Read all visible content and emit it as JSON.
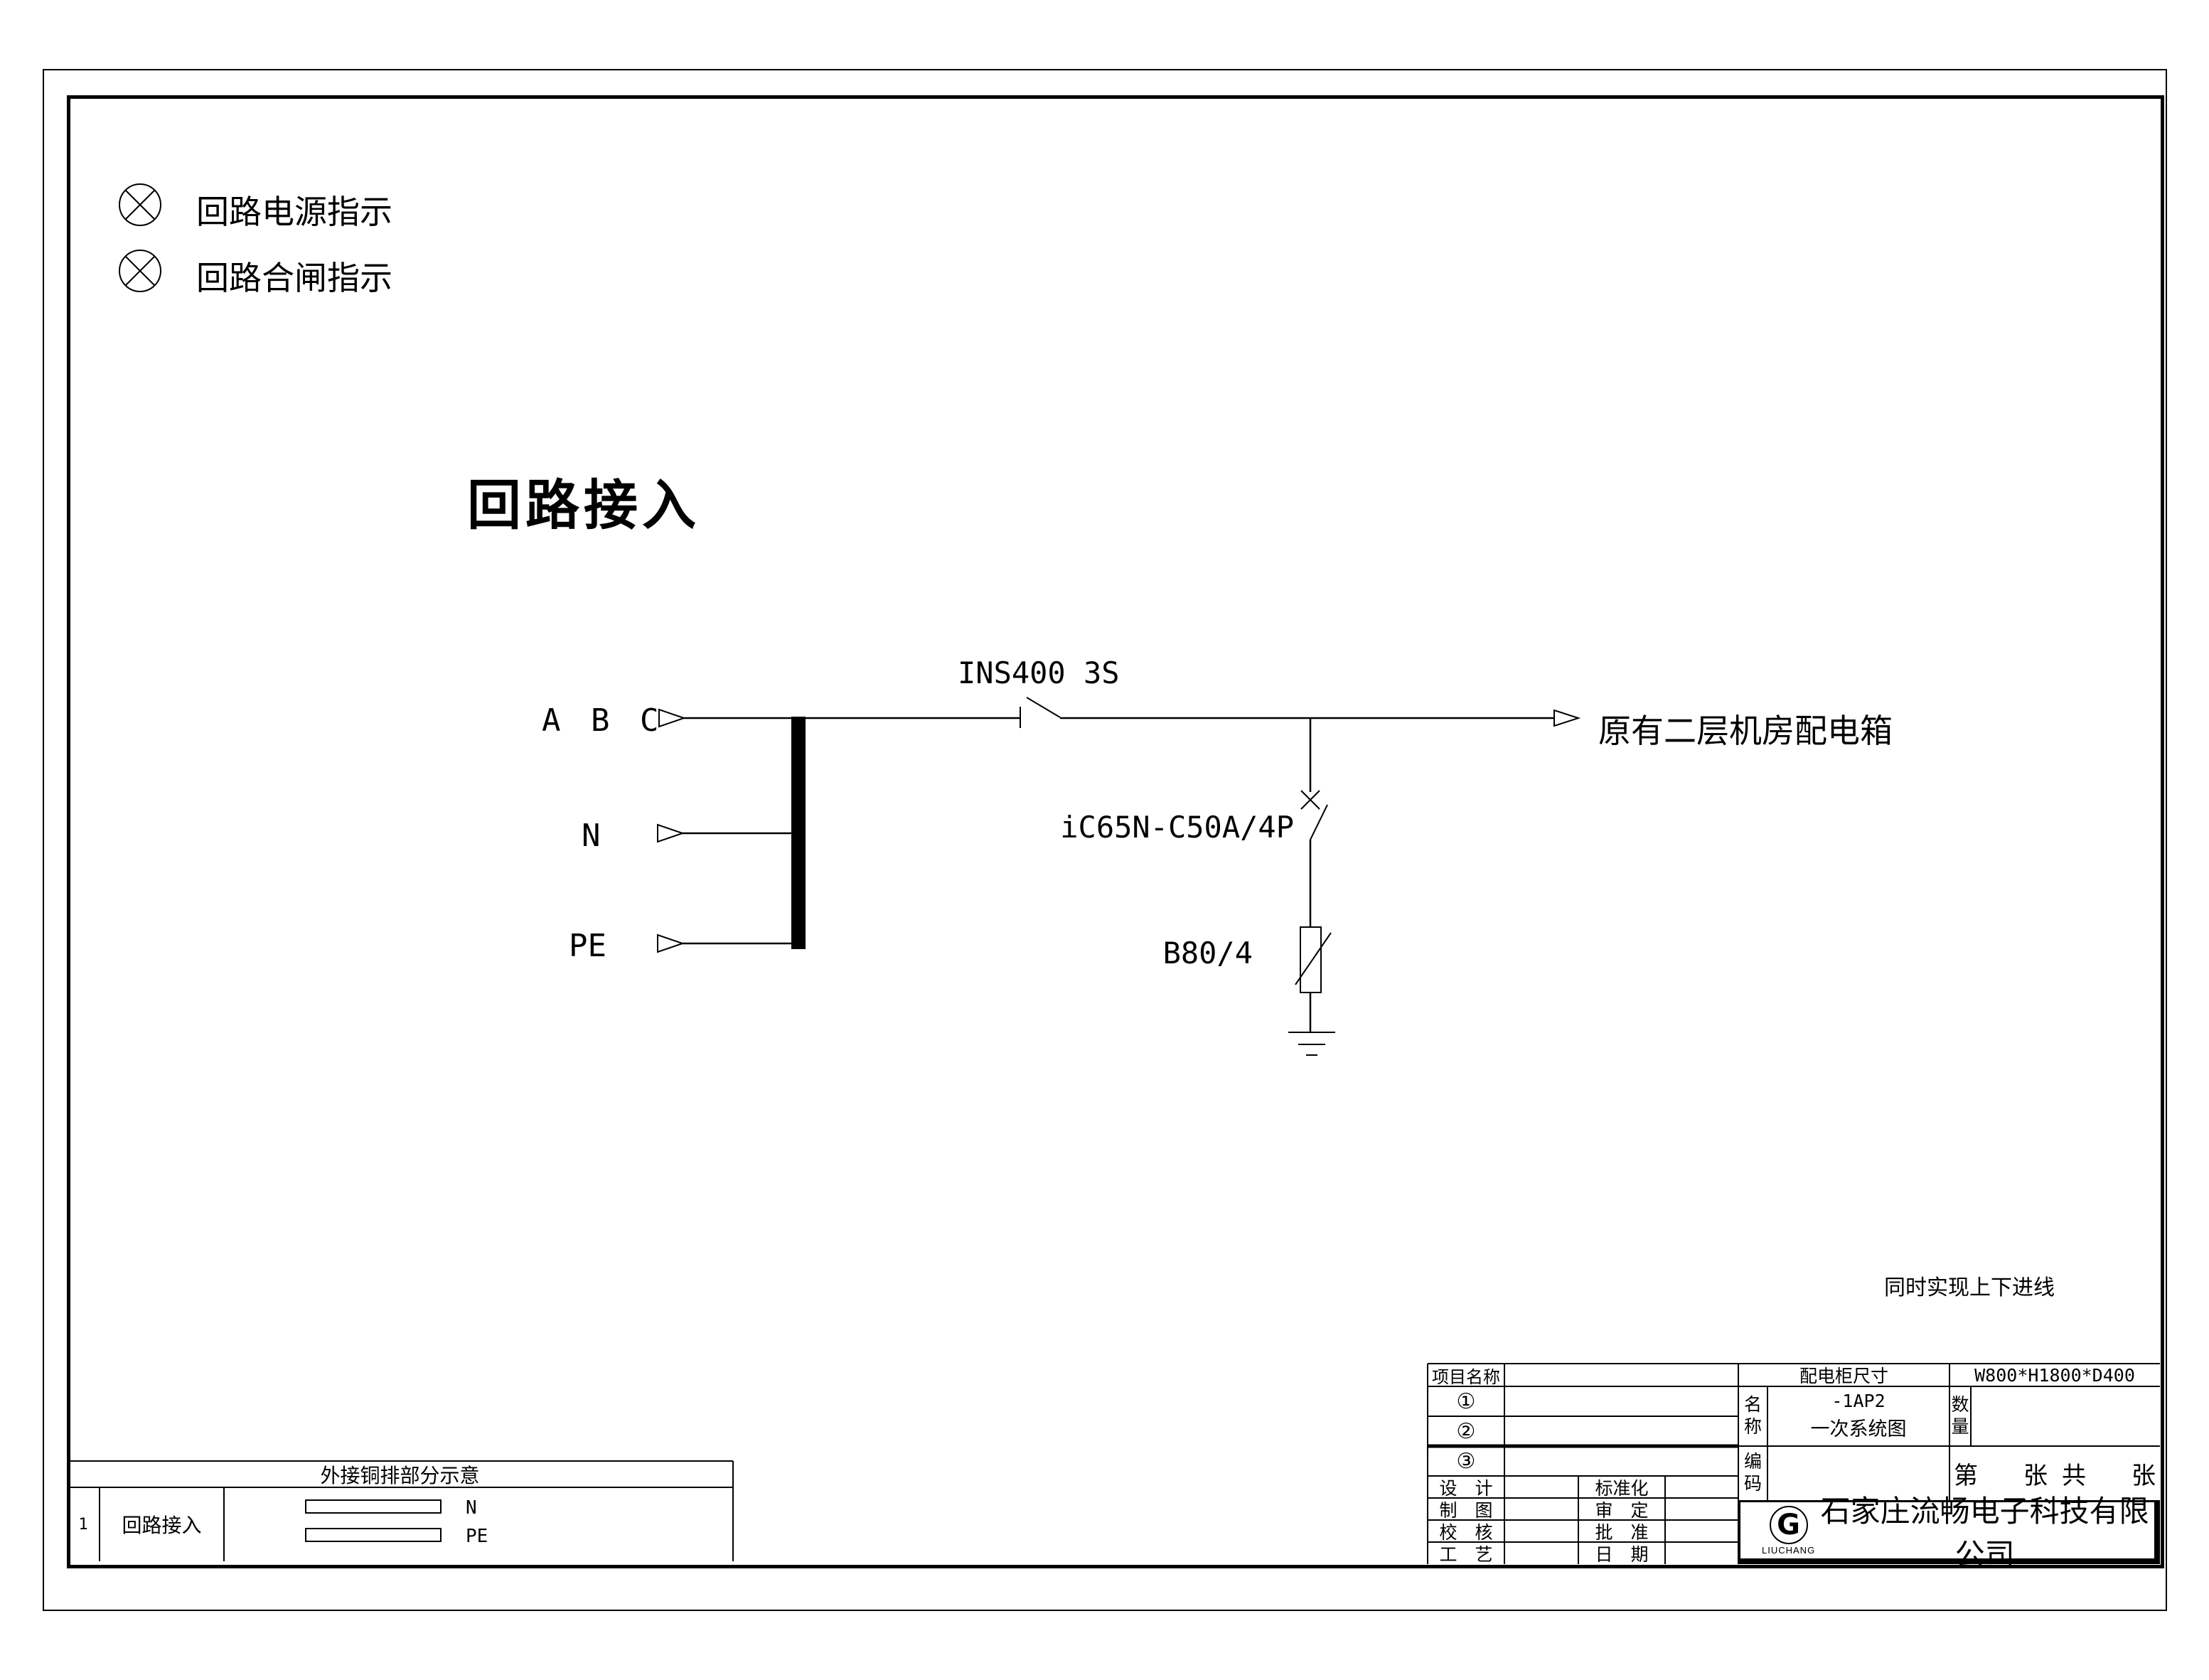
{
  "drawing": {
    "indicators": [
      {
        "label": "回路电源指示"
      },
      {
        "label": "回路合闸指示"
      }
    ],
    "title": "回路接入",
    "incoming": {
      "phases": "A B C",
      "neutral": "N",
      "pe": "PE"
    },
    "isolator": "INS400 3S",
    "outgoing": "原有二层机房配电箱",
    "breaker": "iC65N-C50A/4P",
    "spd": "B80/4",
    "note": "同时实现上下进线"
  },
  "busbar_table": {
    "title": "外接铜排部分示意",
    "row_no": "1",
    "row_label": "回路接入",
    "bars": [
      {
        "label": "N"
      },
      {
        "label": "PE"
      }
    ]
  },
  "title_block": {
    "project_label": "项目名称",
    "item_rows": [
      {
        "no": "①"
      },
      {
        "no": "②"
      },
      {
        "no": "③"
      }
    ],
    "cabinet_size_label": "配电柜尺寸",
    "cabinet_size_value": "W800*H1800*D400",
    "name_label": [
      "名",
      "称"
    ],
    "name_value_line1": "-1AP2",
    "name_value_line2": "一次系统图",
    "qty_label": [
      "数",
      "量"
    ],
    "code_label": [
      "编",
      "码"
    ],
    "sheet": {
      "di": "第",
      "zhang1": "张",
      "gong": "共",
      "zhang2": "张"
    },
    "sign_rows_left": [
      {
        "label": "设　计"
      },
      {
        "label": "制　图"
      },
      {
        "label": "校　核"
      },
      {
        "label": "工　艺"
      }
    ],
    "sign_rows_right": [
      {
        "label": "标准化"
      },
      {
        "label": "审　定"
      },
      {
        "label": "批　准"
      },
      {
        "label": "日　期"
      }
    ],
    "logo": {
      "letter": "G",
      "sub": "LIUCHANG"
    },
    "company": "石家庄流畅电子科技有限公司"
  }
}
